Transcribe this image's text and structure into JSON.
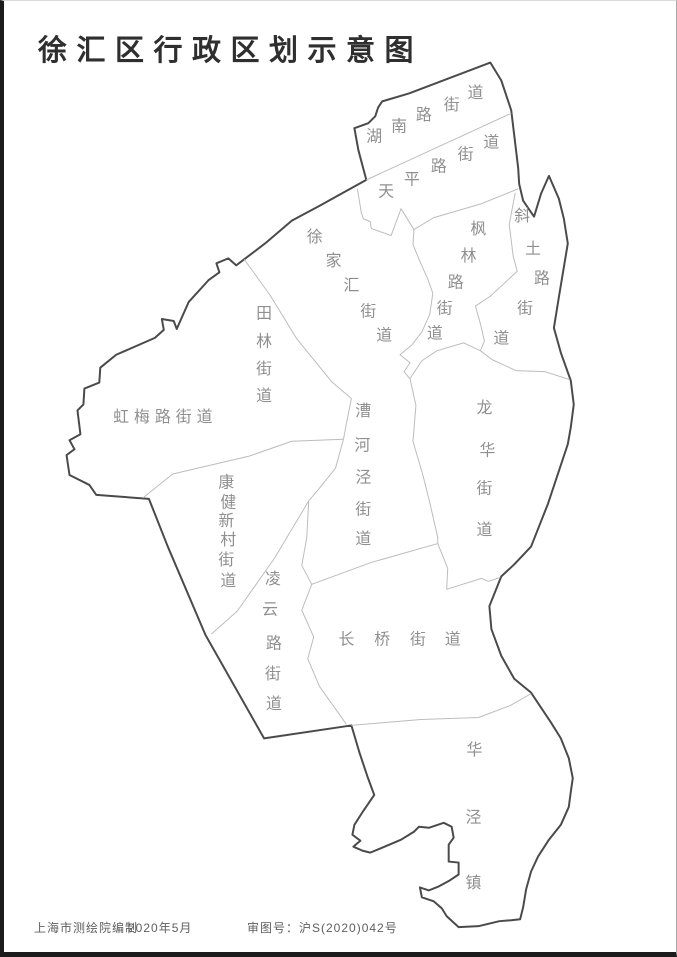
{
  "page": {
    "title": "徐汇区行政区划示意图"
  },
  "footer": {
    "publisher": "上海市测绘院编制",
    "date": "2020年5月",
    "approval": "审图号：沪S(2020)042号"
  },
  "map": {
    "colors": {
      "district_boundary": "#4a4a4a",
      "internal_boundary": "#bcbcbc",
      "label": "#8f8f8f",
      "fill": "#ffffff"
    },
    "label_font_size": 16,
    "outline": [
      [
        490,
        62
      ],
      [
        408,
        93
      ],
      [
        381,
        101
      ],
      [
        377,
        107
      ],
      [
        374,
        116
      ],
      [
        367,
        123
      ],
      [
        353,
        128
      ],
      [
        357,
        150
      ],
      [
        365,
        180
      ],
      [
        318,
        206
      ],
      [
        290,
        221
      ],
      [
        263,
        244
      ],
      [
        234,
        266
      ],
      [
        226,
        259
      ],
      [
        214,
        264
      ],
      [
        217,
        273
      ],
      [
        206,
        281
      ],
      [
        186,
        303
      ],
      [
        174,
        330
      ],
      [
        171,
        322
      ],
      [
        159,
        320
      ],
      [
        161,
        331
      ],
      [
        152,
        339
      ],
      [
        113,
        356
      ],
      [
        97,
        369
      ],
      [
        96,
        384
      ],
      [
        81,
        390
      ],
      [
        80,
        406
      ],
      [
        74,
        412
      ],
      [
        77,
        436
      ],
      [
        66,
        442
      ],
      [
        71,
        451
      ],
      [
        63,
        457
      ],
      [
        66,
        477
      ],
      [
        86,
        487
      ],
      [
        93,
        497
      ],
      [
        146,
        501
      ],
      [
        165,
        549
      ],
      [
        203,
        638
      ],
      [
        262,
        742
      ],
      [
        350,
        729
      ],
      [
        358,
        756
      ],
      [
        366,
        780
      ],
      [
        373,
        799
      ],
      [
        362,
        815
      ],
      [
        353,
        829
      ],
      [
        351,
        839
      ],
      [
        359,
        845
      ],
      [
        352,
        851
      ],
      [
        361,
        855
      ],
      [
        369,
        857
      ],
      [
        381,
        852
      ],
      [
        400,
        844
      ],
      [
        413,
        836
      ],
      [
        418,
        831
      ],
      [
        428,
        832
      ],
      [
        443,
        827
      ],
      [
        451,
        831
      ],
      [
        453,
        842
      ],
      [
        448,
        849
      ],
      [
        448,
        866
      ],
      [
        458,
        867
      ],
      [
        458,
        879
      ],
      [
        449,
        885
      ],
      [
        438,
        891
      ],
      [
        428,
        895
      ],
      [
        419,
        892
      ],
      [
        421,
        902
      ],
      [
        433,
        906
      ],
      [
        441,
        913
      ],
      [
        446,
        921
      ],
      [
        458,
        932
      ],
      [
        478,
        931
      ],
      [
        499,
        926
      ],
      [
        511,
        925
      ],
      [
        520,
        924
      ],
      [
        523,
        912
      ],
      [
        526,
        894
      ],
      [
        531,
        876
      ],
      [
        538,
        861
      ],
      [
        549,
        844
      ],
      [
        561,
        829
      ],
      [
        569,
        811
      ],
      [
        571,
        796
      ],
      [
        573,
        782
      ],
      [
        569,
        762
      ],
      [
        561,
        742
      ],
      [
        551,
        726
      ],
      [
        531,
        696
      ],
      [
        514,
        682
      ],
      [
        501,
        659
      ],
      [
        491,
        632
      ],
      [
        489,
        609
      ],
      [
        501,
        579
      ],
      [
        514,
        567
      ],
      [
        531,
        549
      ],
      [
        548,
        506
      ],
      [
        568,
        446
      ],
      [
        571,
        429
      ],
      [
        574,
        406
      ],
      [
        571,
        382
      ],
      [
        561,
        354
      ],
      [
        554,
        329
      ],
      [
        559,
        298
      ],
      [
        564,
        268
      ],
      [
        568,
        244
      ],
      [
        564,
        219
      ],
      [
        559,
        199
      ],
      [
        549,
        176
      ],
      [
        541,
        194
      ],
      [
        534,
        217
      ],
      [
        523,
        201
      ],
      [
        519,
        184
      ],
      [
        518,
        168
      ],
      [
        511,
        110
      ],
      [
        501,
        80
      ]
    ],
    "borders": [
      [
        [
          365,
          180
        ],
        [
          511,
          113
        ]
      ],
      [
        [
          356,
          189
        ],
        [
          360,
          213
        ],
        [
          362,
          219
        ],
        [
          369,
          222
        ],
        [
          370,
          229
        ],
        [
          390,
          236
        ],
        [
          400,
          209
        ],
        [
          413,
          230
        ]
      ],
      [
        [
          413,
          230
        ],
        [
          433,
          218
        ],
        [
          481,
          204
        ],
        [
          518,
          189
        ]
      ],
      [
        [
          413,
          230
        ],
        [
          412,
          245
        ],
        [
          419,
          262
        ],
        [
          427,
          280
        ],
        [
          432,
          294
        ],
        [
          429,
          315
        ],
        [
          421,
          333
        ],
        [
          411,
          346
        ],
        [
          399,
          356
        ],
        [
          409,
          364
        ],
        [
          403,
          373
        ],
        [
          409,
          380
        ]
      ],
      [
        [
          409,
          380
        ],
        [
          421,
          362
        ],
        [
          436,
          352
        ],
        [
          463,
          344
        ],
        [
          480,
          352
        ],
        [
          492,
          361
        ],
        [
          516,
          372
        ],
        [
          545,
          373
        ],
        [
          570,
          381
        ]
      ],
      [
        [
          515,
          193
        ],
        [
          509,
          225
        ],
        [
          513,
          257
        ],
        [
          517,
          272
        ],
        [
          490,
          297
        ],
        [
          475,
          307
        ],
        [
          480,
          325
        ],
        [
          484,
          342
        ],
        [
          480,
          352
        ]
      ],
      [
        [
          409,
          380
        ],
        [
          415,
          407
        ],
        [
          412,
          443
        ],
        [
          422,
          477
        ],
        [
          429,
          505
        ],
        [
          437,
          540
        ],
        [
          437,
          546
        ]
      ],
      [
        [
          242,
          260
        ],
        [
          268,
          296
        ],
        [
          295,
          340
        ],
        [
          330,
          383
        ],
        [
          350,
          400
        ]
      ],
      [
        [
          350,
          400
        ],
        [
          345,
          425
        ],
        [
          342,
          441
        ]
      ],
      [
        [
          342,
          441
        ],
        [
          290,
          443
        ],
        [
          247,
          458
        ],
        [
          170,
          476
        ],
        [
          140,
          500
        ]
      ],
      [
        [
          342,
          441
        ],
        [
          334,
          470
        ],
        [
          318,
          490
        ],
        [
          307,
          503
        ]
      ],
      [
        [
          307,
          503
        ],
        [
          273,
          560
        ],
        [
          235,
          614
        ],
        [
          209,
          637
        ]
      ],
      [
        [
          307,
          503
        ],
        [
          305,
          540
        ],
        [
          300,
          568
        ],
        [
          310,
          587
        ],
        [
          300,
          613
        ],
        [
          312,
          640
        ],
        [
          306,
          662
        ],
        [
          318,
          690
        ],
        [
          333,
          711
        ],
        [
          345,
          728
        ]
      ],
      [
        [
          310,
          587
        ],
        [
          370,
          565
        ],
        [
          437,
          546
        ]
      ],
      [
        [
          437,
          546
        ],
        [
          447,
          571
        ],
        [
          446,
          592
        ],
        [
          462,
          587
        ],
        [
          481,
          581
        ],
        [
          488,
          584
        ],
        [
          500,
          580
        ]
      ],
      [
        [
          350,
          729
        ],
        [
          420,
          723
        ],
        [
          478,
          721
        ],
        [
          510,
          709
        ],
        [
          531,
          697
        ]
      ]
    ],
    "regions": [
      {
        "id": "hunan-road-subdistrict",
        "name": "湖南路街道",
        "chars": [
          [
            "湖",
            373,
            137
          ],
          [
            "南",
            398,
            127
          ],
          [
            "路",
            423,
            115
          ],
          [
            "街",
            451,
            105
          ],
          [
            "道",
            475,
            93
          ]
        ]
      },
      {
        "id": "tianping-road-subdistrict",
        "name": "天平路街道",
        "chars": [
          [
            "天",
            385,
            192
          ],
          [
            "平",
            411,
            180
          ],
          [
            "路",
            438,
            167
          ],
          [
            "街",
            465,
            155
          ],
          [
            "道",
            491,
            143
          ]
        ]
      },
      {
        "id": "xujiahui-subdistrict",
        "name": "徐家汇街道",
        "chars": [
          [
            "徐",
            313,
            238
          ],
          [
            "家",
            332,
            262
          ],
          [
            "汇",
            350,
            287
          ],
          [
            "街",
            367,
            313
          ],
          [
            "道",
            383,
            337
          ]
        ]
      },
      {
        "id": "fenglin-road-subdistrict",
        "name": "枫林路街道",
        "chars": [
          [
            "枫",
            478,
            230
          ],
          [
            "林",
            468,
            257
          ],
          [
            "路",
            455,
            284
          ],
          [
            "街",
            444,
            310
          ],
          [
            "道",
            434,
            335
          ]
        ]
      },
      {
        "id": "xietu-road-subdistrict",
        "name": "斜土路街道",
        "chars": [
          [
            "斜",
            522,
            217
          ],
          [
            "土",
            533,
            250
          ],
          [
            "路",
            542,
            280
          ],
          [
            "街",
            525,
            310
          ],
          [
            "道",
            501,
            340
          ]
        ]
      },
      {
        "id": "tianlin-subdistrict",
        "name": "田林街道",
        "chars": [
          [
            "田",
            262,
            315
          ],
          [
            "林",
            262,
            343
          ],
          [
            "街",
            262,
            371
          ],
          [
            "道",
            262,
            398
          ]
        ]
      },
      {
        "id": "hongmei-road-subdistrict",
        "name": "虹梅路街道",
        "chars": [
          [
            "虹",
            118,
            419
          ],
          [
            "梅",
            139,
            419
          ],
          [
            "路",
            160,
            419
          ],
          [
            "街",
            181,
            419
          ],
          [
            "道",
            202,
            419
          ]
        ]
      },
      {
        "id": "kangjian-xincun-subdistrict",
        "name": "康健新村街道",
        "chars": [
          [
            "康",
            224,
            485
          ],
          [
            "健",
            226,
            505
          ],
          [
            "新",
            224,
            524
          ],
          [
            "村",
            226,
            543
          ],
          [
            "街",
            224,
            563
          ],
          [
            "道",
            226,
            584
          ]
        ]
      },
      {
        "id": "caohejing-subdistrict",
        "name": "漕河泾街道",
        "chars": [
          [
            "漕",
            362,
            413
          ],
          [
            "河",
            361,
            448
          ],
          [
            "泾",
            362,
            480
          ],
          [
            "街",
            362,
            512
          ],
          [
            "道",
            362,
            542
          ]
        ]
      },
      {
        "id": "lingyun-road-subdistrict",
        "name": "凌云路街道",
        "chars": [
          [
            "凌",
            271,
            582
          ],
          [
            "云",
            268,
            613
          ],
          [
            "路",
            272,
            647
          ],
          [
            "街",
            271,
            678
          ],
          [
            "道",
            272,
            708
          ]
        ]
      },
      {
        "id": "longhua-subdistrict",
        "name": "龙华街道",
        "chars": [
          [
            "龙",
            484,
            410
          ],
          [
            "华",
            487,
            453
          ],
          [
            "街",
            484,
            491
          ],
          [
            "道",
            484,
            533
          ]
        ]
      },
      {
        "id": "changqiao-subdistrict",
        "name": "长桥街道",
        "chars": [
          [
            "长",
            345,
            643
          ],
          [
            "桥",
            381,
            643
          ],
          [
            "街",
            417,
            643
          ],
          [
            "道",
            452,
            643
          ]
        ]
      },
      {
        "id": "huajing-town",
        "name": "华泾镇",
        "chars": [
          [
            "华",
            474,
            754
          ],
          [
            "泾",
            473,
            822
          ],
          [
            "镇",
            473,
            888
          ]
        ]
      }
    ]
  }
}
